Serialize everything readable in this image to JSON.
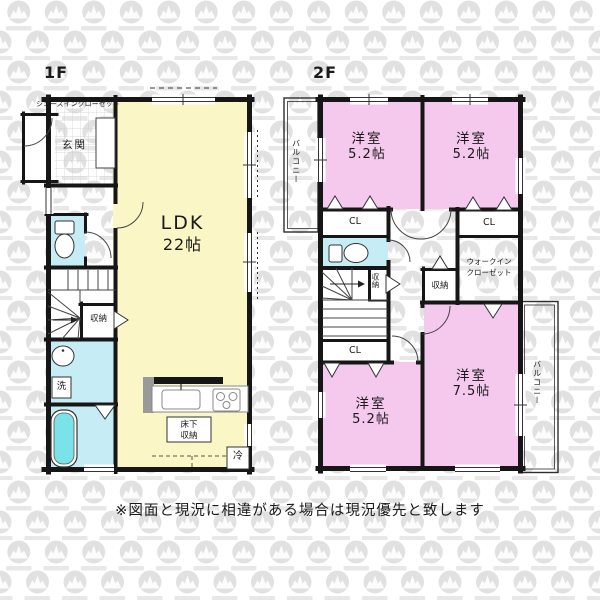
{
  "titles": {
    "f1": "1F",
    "f2": "2F"
  },
  "disclaimer": "※図面と現況に相違がある場合は現況優先と致します",
  "colors": {
    "wall": "#161616",
    "ldk": "#FAF6C5",
    "bedroom": "#F5C8EE",
    "wet": "#C6EDF6",
    "tub": "#7CE2EA"
  },
  "f1": {
    "shoes_closet": "シューズインクローゼット",
    "entrance": "玄関",
    "ldk": {
      "name": "LDK",
      "size": "22帖"
    },
    "storage": "収納",
    "laundry": "洗",
    "underfloor": {
      "line1": "床下",
      "line2": "収納"
    },
    "fridge": "冷"
  },
  "f2": {
    "balcony_left": "バルコニー",
    "balcony_right": "バルコニー",
    "bedroom_top_left": {
      "name": "洋室",
      "size": "5.2帖"
    },
    "bedroom_top_right": {
      "name": "洋室",
      "size": "5.2帖"
    },
    "bedroom_bottom_left": {
      "name": "洋室",
      "size": "5.2帖"
    },
    "bedroom_right": {
      "name": "洋室",
      "size": "7.5帖"
    },
    "closet_top_left": "CL",
    "closet_top_right": "CL",
    "closet_bottom_left": "CL",
    "wic": {
      "line1": "ウォークイン",
      "line2": "クローゼット"
    },
    "storage_stairs": "収納",
    "storage_hall": "収納"
  }
}
